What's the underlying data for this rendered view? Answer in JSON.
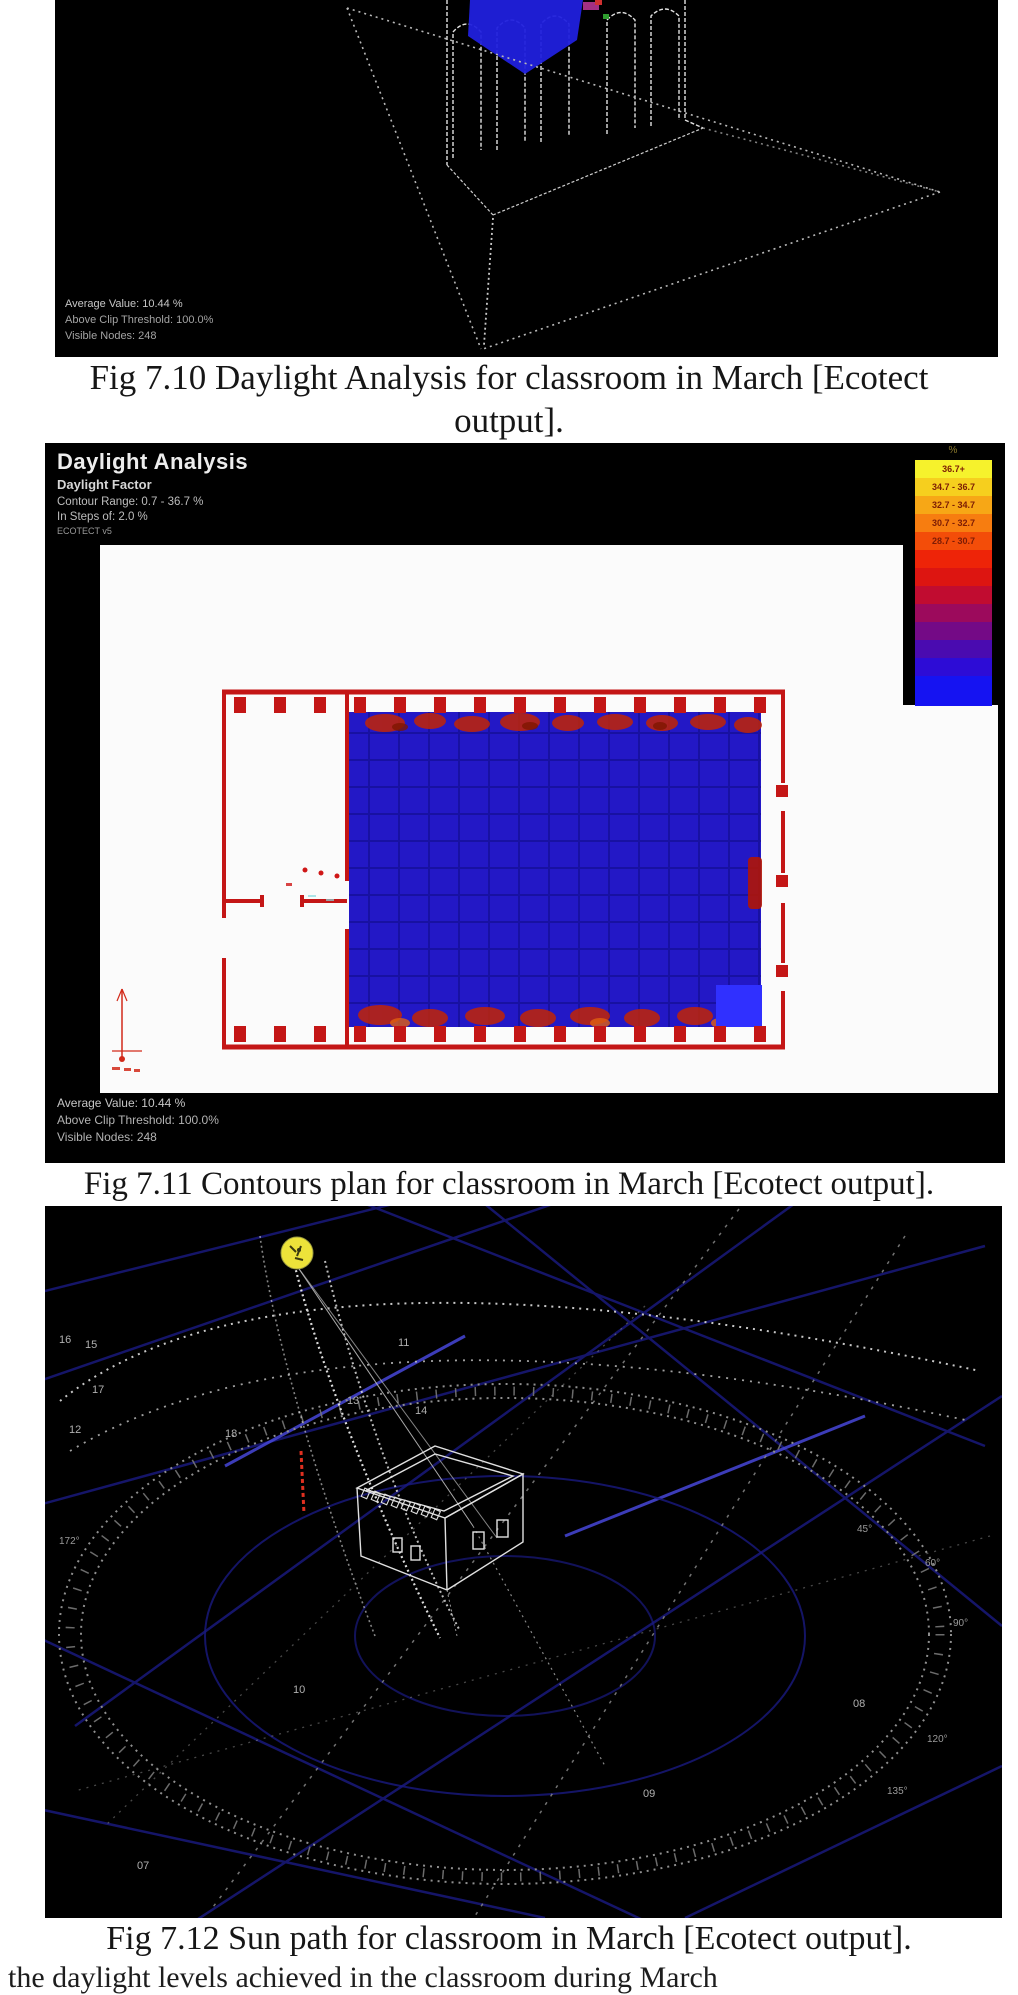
{
  "fig710": {
    "stats": [
      "Average Value: 10.44 %",
      "Above Clip Threshold: 100.0%",
      "Visible Nodes: 248"
    ],
    "caption_line1": "Fig 7.10 Daylight Analysis for classroom in March [Ecotect",
    "caption_line2": "output]."
  },
  "fig711": {
    "title": "Daylight Analysis",
    "subtitle": "Daylight Factor",
    "contour_range": "Contour Range: 0.7 - 36.7 %",
    "steps_label": "In Steps of: 2.0 %",
    "brand": "ECOTECT v5",
    "legend_unit": "%",
    "legend_bands": [
      {
        "label": "36.7+",
        "color": "#f6f22c"
      },
      {
        "label": "34.7 - 36.7",
        "color": "#f6cf1e"
      },
      {
        "label": "32.7 - 34.7",
        "color": "#f7a716"
      },
      {
        "label": "30.7 - 32.7",
        "color": "#f77d10"
      },
      {
        "label": "28.7 - 30.7",
        "color": "#f34d09"
      },
      {
        "label": "",
        "color": "#ee2408"
      },
      {
        "label": "",
        "color": "#dd1511"
      },
      {
        "label": "",
        "color": "#c10c30"
      },
      {
        "label": "",
        "color": "#9c0a5c"
      },
      {
        "label": "",
        "color": "#740a86"
      },
      {
        "label": "",
        "color": "#4a0bb0"
      },
      {
        "label": "",
        "color": "#2d0cd6"
      },
      {
        "label": "",
        "color": "#1513f2"
      }
    ],
    "stats": [
      "Average Value: 10.44 %",
      "Above Clip Threshold: 100.0%",
      "Visible Nodes: 248"
    ],
    "caption": "Fig 7.11 Contours plan for classroom in March [Ecotect output]."
  },
  "fig712": {
    "caption": "Fig 7.12 Sun path for classroom in March [Ecotect output].",
    "hour_labels": [
      {
        "text": "16",
        "x": 14,
        "y": 128
      },
      {
        "text": "15",
        "x": 40,
        "y": 133
      },
      {
        "text": "17",
        "x": 47,
        "y": 178
      },
      {
        "text": "12",
        "x": 24,
        "y": 218
      },
      {
        "text": "18",
        "x": 180,
        "y": 222
      },
      {
        "text": "13",
        "x": 302,
        "y": 189
      },
      {
        "text": "14",
        "x": 370,
        "y": 199
      },
      {
        "text": "11",
        "x": 353,
        "y": 131
      },
      {
        "text": "10",
        "x": 248,
        "y": 478
      },
      {
        "text": "09",
        "x": 598,
        "y": 582
      },
      {
        "text": "08",
        "x": 808,
        "y": 492
      },
      {
        "text": "07",
        "x": 92,
        "y": 654
      }
    ],
    "degree_labels": [
      {
        "text": "45°",
        "x": 812,
        "y": 318
      },
      {
        "text": "60°",
        "x": 880,
        "y": 352
      },
      {
        "text": "90°",
        "x": 908,
        "y": 412
      },
      {
        "text": "120°",
        "x": 882,
        "y": 528
      },
      {
        "text": "135°",
        "x": 842,
        "y": 580
      },
      {
        "text": "172°",
        "x": 14,
        "y": 330
      }
    ]
  },
  "bottom_clipped_line": "the daylight levels achieved in the classroom during March"
}
